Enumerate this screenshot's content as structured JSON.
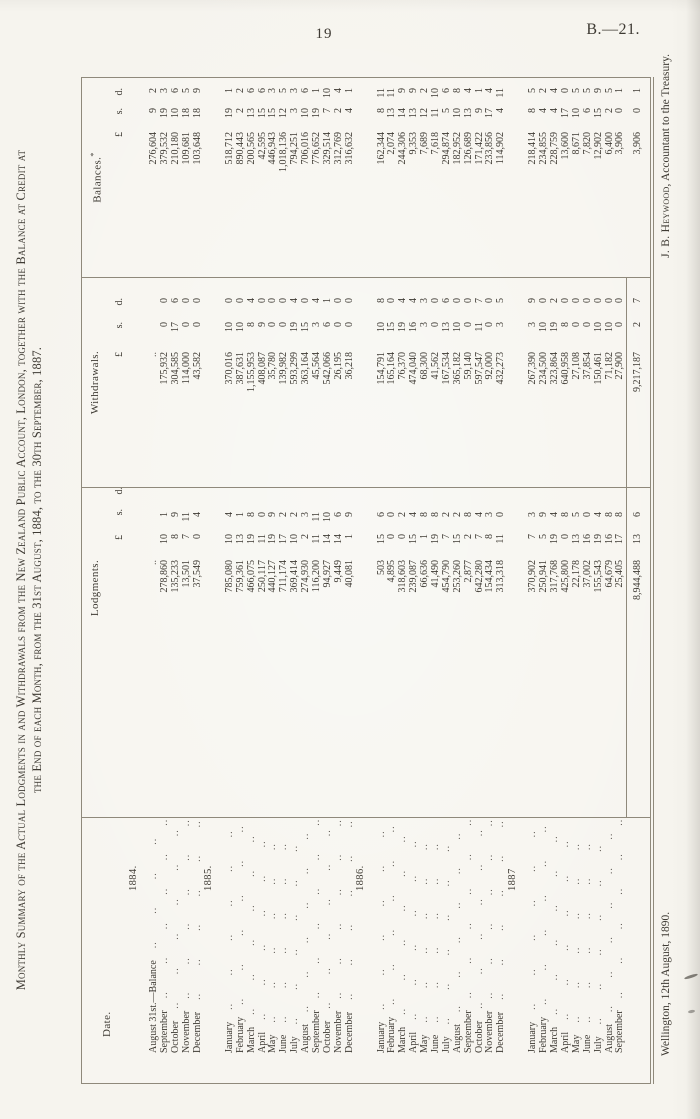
{
  "page": {
    "number": "19",
    "reference": "B.—21."
  },
  "title": {
    "line1": "Monthly Summary of the Actual Lodgments in and Withdrawals from the New Zealand Public Account, London, together with the Balance at Credit at",
    "line2": "the End of each Month, from the 31st August, 1884, to the 30th September, 1887."
  },
  "table": {
    "headers": {
      "date": "Date.",
      "lodgments": "Lodgments.",
      "withdrawals": "Withdrawals.",
      "balances": "Balances.",
      "balances_note_mark": "*",
      "currency": {
        "pounds": "£",
        "shillings": "s.",
        "pence": "d."
      }
    },
    "groups": [
      {
        "year": "1884.",
        "rows": [
          {
            "date": "August 31st.—Balance",
            "lodgment": null,
            "withdrawal": null,
            "balance": [
              "276,604",
              "9",
              "2"
            ]
          },
          {
            "date": "September",
            "lodgment": [
              "278,860",
              "10",
              "1"
            ],
            "withdrawal": [
              "175,932",
              "0",
              "0"
            ],
            "balance": [
              "379,532",
              "19",
              "3"
            ]
          },
          {
            "date": "October",
            "lodgment": [
              "135,233",
              "8",
              "9"
            ],
            "withdrawal": [
              "304,585",
              "17",
              "6"
            ],
            "balance": [
              "210,180",
              "10",
              "6"
            ]
          },
          {
            "date": "November",
            "lodgment": [
              "13,501",
              "7",
              "11"
            ],
            "withdrawal": [
              "114,000",
              "0",
              "0"
            ],
            "balance": [
              "109,681",
              "18",
              "5"
            ]
          },
          {
            "date": "December",
            "lodgment": [
              "37,549",
              "0",
              "4"
            ],
            "withdrawal": [
              "43,582",
              "0",
              "0"
            ],
            "balance": [
              "103,648",
              "18",
              "9"
            ]
          }
        ]
      },
      {
        "year": "1885.",
        "rows": [
          {
            "date": "January",
            "lodgment": [
              "785,080",
              "10",
              "4"
            ],
            "withdrawal": [
              "370,016",
              "10",
              "0"
            ],
            "balance": [
              "518,712",
              "19",
              "1"
            ]
          },
          {
            "date": "February",
            "lodgment": [
              "759,361",
              "13",
              "1"
            ],
            "withdrawal": [
              "387,631",
              "10",
              "0"
            ],
            "balance": [
              "890,443",
              "2",
              "2"
            ]
          },
          {
            "date": "March",
            "lodgment": [
              "466,075",
              "19",
              "8"
            ],
            "withdrawal": [
              "1,155,953",
              "8",
              "4"
            ],
            "balance": [
              "200,565",
              "13",
              "6"
            ]
          },
          {
            "date": "April",
            "lodgment": [
              "250,117",
              "11",
              "0"
            ],
            "withdrawal": [
              "408,087",
              "9",
              "0"
            ],
            "balance": [
              "42,595",
              "15",
              "6"
            ]
          },
          {
            "date": "May",
            "lodgment": [
              "440,127",
              "19",
              "9"
            ],
            "withdrawal": [
              "35,780",
              "0",
              "0"
            ],
            "balance": [
              "446,943",
              "15",
              "3"
            ]
          },
          {
            "date": "June",
            "lodgment": [
              "711,174",
              "17",
              "2"
            ],
            "withdrawal": [
              "139,982",
              "0",
              "0"
            ],
            "balance": [
              "1,018,136",
              "12",
              "5"
            ]
          },
          {
            "date": "July",
            "lodgment": [
              "369,414",
              "10",
              "2"
            ],
            "withdrawal": [
              "593,299",
              "19",
              "4"
            ],
            "balance": [
              "794,251",
              "3",
              "3"
            ]
          },
          {
            "date": "August",
            "lodgment": [
              "274,930",
              "2",
              "3"
            ],
            "withdrawal": [
              "363,164",
              "15",
              "0"
            ],
            "balance": [
              "706,016",
              "10",
              "6"
            ]
          },
          {
            "date": "September",
            "lodgment": [
              "116,200",
              "11",
              "11"
            ],
            "withdrawal": [
              "45,564",
              "3",
              "4"
            ],
            "balance": [
              "776,652",
              "19",
              "1"
            ]
          },
          {
            "date": "October",
            "lodgment": [
              "94,927",
              "14",
              "10"
            ],
            "withdrawal": [
              "542,066",
              "6",
              "1"
            ],
            "balance": [
              "329,514",
              "7",
              "10"
            ]
          },
          {
            "date": "November",
            "lodgment": [
              "9,449",
              "14",
              "6"
            ],
            "withdrawal": [
              "26,195",
              "0",
              "0"
            ],
            "balance": [
              "312,769",
              "2",
              "4"
            ]
          },
          {
            "date": "December",
            "lodgment": [
              "40,081",
              "1",
              "9"
            ],
            "withdrawal": [
              "36,218",
              "0",
              "0"
            ],
            "balance": [
              "316,632",
              "4",
              "1"
            ]
          }
        ]
      },
      {
        "year": "1886.",
        "rows": [
          {
            "date": "January",
            "lodgment": [
              "503",
              "15",
              "6"
            ],
            "withdrawal": [
              "154,791",
              "10",
              "8"
            ],
            "balance": [
              "162,344",
              "8",
              "11"
            ]
          },
          {
            "date": "February",
            "lodgment": [
              "4,895",
              "0",
              "0"
            ],
            "withdrawal": [
              "165,164",
              "15",
              "0"
            ],
            "balance": [
              "2,074",
              "13",
              "11"
            ]
          },
          {
            "date": "March",
            "lodgment": [
              "318,603",
              "0",
              "2"
            ],
            "withdrawal": [
              "76,370",
              "19",
              "4"
            ],
            "balance": [
              "244,306",
              "14",
              "9"
            ]
          },
          {
            "date": "April",
            "lodgment": [
              "239,087",
              "15",
              "4"
            ],
            "withdrawal": [
              "474,040",
              "16",
              "4"
            ],
            "balance": [
              "9,353",
              "13",
              "9"
            ]
          },
          {
            "date": "May",
            "lodgment": [
              "66,636",
              "1",
              "8"
            ],
            "withdrawal": [
              "68,300",
              "3",
              "3"
            ],
            "balance": [
              "7,689",
              "12",
              "2"
            ]
          },
          {
            "date": "June",
            "lodgment": [
              "41,490",
              "19",
              "8"
            ],
            "withdrawal": [
              "41,562",
              "0",
              "0"
            ],
            "balance": [
              "7,618",
              "11",
              "10"
            ]
          },
          {
            "date": "July",
            "lodgment": [
              "454,790",
              "7",
              "2"
            ],
            "withdrawal": [
              "167,534",
              "13",
              "6"
            ],
            "balance": [
              "294,874",
              "5",
              "6"
            ]
          },
          {
            "date": "August",
            "lodgment": [
              "253,260",
              "15",
              "2"
            ],
            "withdrawal": [
              "365,182",
              "10",
              "0"
            ],
            "balance": [
              "182,952",
              "10",
              "8"
            ]
          },
          {
            "date": "September",
            "lodgment": [
              "2,877",
              "2",
              "8"
            ],
            "withdrawal": [
              "59,140",
              "0",
              "0"
            ],
            "balance": [
              "126,689",
              "13",
              "4"
            ]
          },
          {
            "date": "October",
            "lodgment": [
              "642,280",
              "7",
              "4"
            ],
            "withdrawal": [
              "597,547",
              "11",
              "7"
            ],
            "balance": [
              "171,422",
              "9",
              "1"
            ]
          },
          {
            "date": "November",
            "lodgment": [
              "154,434",
              "8",
              "3"
            ],
            "withdrawal": [
              "92,000",
              "0",
              "0"
            ],
            "balance": [
              "233,856",
              "17",
              "4"
            ]
          },
          {
            "date": "December",
            "lodgment": [
              "313,318",
              "11",
              "0"
            ],
            "withdrawal": [
              "432,273",
              "3",
              "5"
            ],
            "balance": [
              "114,902",
              "4",
              "11"
            ]
          }
        ]
      },
      {
        "year": "1887",
        "rows": [
          {
            "date": "January",
            "lodgment": [
              "370,902",
              "7",
              "3"
            ],
            "withdrawal": [
              "267,390",
              "3",
              "9"
            ],
            "balance": [
              "218,414",
              "8",
              "5"
            ]
          },
          {
            "date": "February",
            "lodgment": [
              "250,941",
              "5",
              "9"
            ],
            "withdrawal": [
              "234,500",
              "10",
              "0"
            ],
            "balance": [
              "234,855",
              "4",
              "2"
            ]
          },
          {
            "date": "March",
            "lodgment": [
              "317,768",
              "19",
              "4"
            ],
            "withdrawal": [
              "323,864",
              "19",
              "2"
            ],
            "balance": [
              "228,759",
              "4",
              "4"
            ]
          },
          {
            "date": "April",
            "lodgment": [
              "425,800",
              "0",
              "8"
            ],
            "withdrawal": [
              "640,958",
              "8",
              "0"
            ],
            "balance": [
              "13,600",
              "17",
              "0"
            ]
          },
          {
            "date": "May",
            "lodgment": [
              "22,178",
              "13",
              "5"
            ],
            "withdrawal": [
              "27,108",
              "0",
              "0"
            ],
            "balance": [
              "8,671",
              "10",
              "5"
            ]
          },
          {
            "date": "June",
            "lodgment": [
              "37,002",
              "16",
              "0"
            ],
            "withdrawal": [
              "37,854",
              "0",
              "0"
            ],
            "balance": [
              "7,820",
              "6",
              "5"
            ]
          },
          {
            "date": "July",
            "lodgment": [
              "155,543",
              "19",
              "4"
            ],
            "withdrawal": [
              "150,461",
              "10",
              "0"
            ],
            "balance": [
              "12,902",
              "15",
              "9"
            ]
          },
          {
            "date": "August",
            "lodgment": [
              "64,679",
              "16",
              "8"
            ],
            "withdrawal": [
              "71,182",
              "10",
              "0"
            ],
            "balance": [
              "6,400",
              "2",
              "5"
            ]
          },
          {
            "date": "September",
            "lodgment": [
              "25,405",
              "17",
              "8"
            ],
            "withdrawal": [
              "27,900",
              "0",
              "0"
            ],
            "balance": [
              "3,906",
              "0",
              "1"
            ]
          }
        ]
      }
    ],
    "totals": {
      "lodgments": [
        "8,944,488",
        "13",
        "6"
      ],
      "withdrawals": [
        "9,217,187",
        "2",
        "7"
      ],
      "balances": [
        "3,906",
        "0",
        "1"
      ]
    }
  },
  "footer": {
    "place_date": "Wellington, 12th August, 1890.",
    "signature_name": "J. B. Heywood,",
    "signature_title": "Accountant to the Treasury."
  }
}
